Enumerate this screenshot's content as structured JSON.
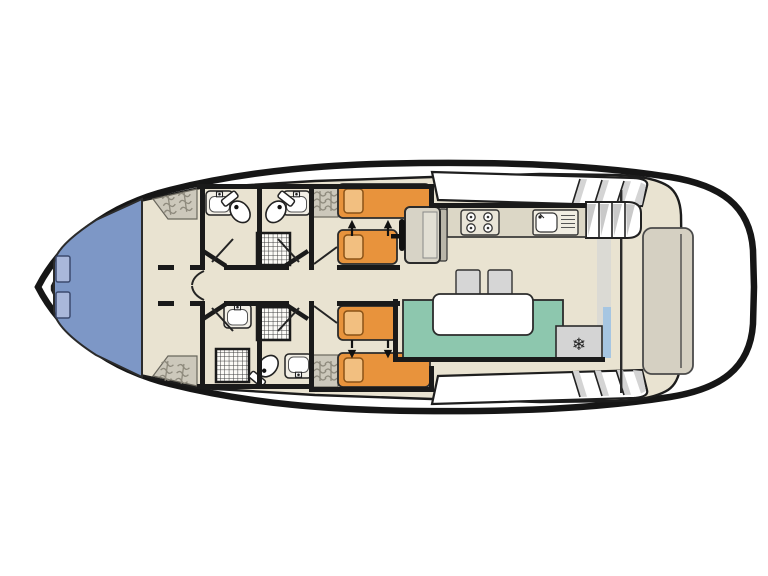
{
  "diagram": {
    "type": "boat-floor-plan",
    "view": "top-down",
    "orientation": "bow-left-stern-right",
    "areas": [
      {
        "id": "bow-deck",
        "desc": "blue bow cockpit with two hatches"
      },
      {
        "id": "forward-lobby",
        "desc": "entry lobby with two wardrobes"
      },
      {
        "id": "bathroom-top-left",
        "desc": "washbasin and toilet"
      },
      {
        "id": "bathroom-top-right",
        "desc": "washbasin, toilet and shower"
      },
      {
        "id": "bathroom-bottom-left",
        "desc": "washbasin and shower"
      },
      {
        "id": "bathroom-bottom-right",
        "desc": "shower, toilet and washbasin"
      },
      {
        "id": "cabin-top",
        "desc": "twin cabin, two single beds with merge arrows"
      },
      {
        "id": "cabin-bottom",
        "desc": "twin cabin, two single beds with merge arrows"
      },
      {
        "id": "corridor",
        "desc": "central corridor"
      },
      {
        "id": "helm",
        "desc": "helm seat with steering wheel"
      },
      {
        "id": "galley",
        "desc": "counter with 4-burner stove and sink"
      },
      {
        "id": "saloon",
        "desc": "teal dinette bench with white table, two stools, fridge"
      },
      {
        "id": "aft-deck",
        "desc": "stern deck with bench, reached by stairs"
      }
    ],
    "inventory": {
      "single_beds": 4,
      "pillows": 4,
      "bed_merge_arrows": 4,
      "wardrobes": 4,
      "toilets": 3,
      "washbasins": 4,
      "showers": 3,
      "stove_burners": 4,
      "galley_sink": 1,
      "fridge_freezer": 1,
      "stools": 2,
      "dinette_table": 1,
      "helm_seat": 1,
      "steering_wheel": 1,
      "bow_hatches": 2,
      "aft_bench": 1,
      "aft_stairs": 1,
      "side_deck_step_flights": 2,
      "sliding_door": 1
    }
  },
  "icons": {
    "freezer": "❄",
    "bed_merge_arrow_up": "▲",
    "bed_merge_arrow_down": "▼"
  },
  "colors": {
    "hull": "#161616",
    "deck_beige": "#e9e3d1",
    "bow_blue": "#7d97c6",
    "hatch_blue": "#a9b7da",
    "bed_orange": "#e8933c",
    "pillow_orange": "#f2bf80",
    "dinette_teal": "#8dc7ae",
    "wardrobe_grey": "#ccc8bb",
    "appliance_grey": "#d4d4d4",
    "sliding_door_blue": "#a6c6e2",
    "wall_black": "#1a1a1a"
  }
}
